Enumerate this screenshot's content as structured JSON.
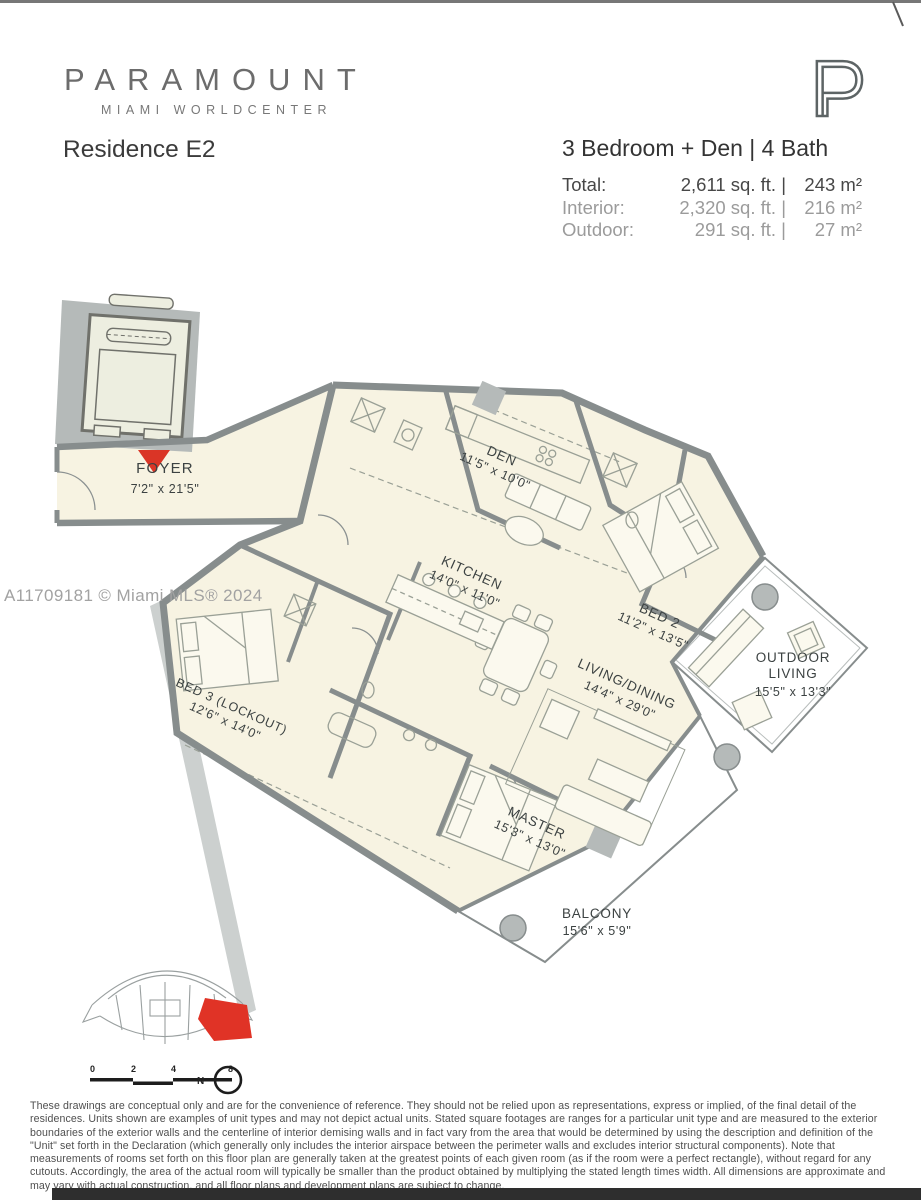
{
  "header": {
    "brand": "PARAMOUNT",
    "brand_subtitle": "MIAMI WORLDCENTER",
    "residence_name": "Residence E2",
    "configuration": "3 Bedroom + Den | 4 Bath",
    "area_rows": [
      {
        "label": "Total:",
        "sqft": "2,611 sq. ft. |",
        "metric": "243 m²"
      },
      {
        "label": "Interior:",
        "sqft": "2,320 sq. ft. |",
        "metric": "216 m²"
      },
      {
        "label": "Outdoor:",
        "sqft": "291 sq. ft. |",
        "metric": "27 m²"
      }
    ]
  },
  "watermark": "A11709181 © Miami MLS® 2024",
  "floorplan": {
    "rooms": {
      "foyer": {
        "name": "FOYER",
        "dims": "7'2\" x 21'5\""
      },
      "den": {
        "name": "DEN",
        "dims": "11'5\" x 10'0\""
      },
      "kitchen": {
        "name": "KITCHEN",
        "dims": "14'0\" x 11'0\""
      },
      "bed2": {
        "name": "BED 2",
        "dims": "11'2\" x 13'5\""
      },
      "living": {
        "name": "LIVING/DINING",
        "dims": "14'4\" x 29'0\""
      },
      "outdoor": {
        "line1": "OUTDOOR",
        "line2": "LIVING",
        "dims": "15'5\" x 13'3\""
      },
      "master": {
        "name": "MASTER",
        "dims": "15'3\" x 13'0\""
      },
      "bed3": {
        "name": "BED 3 (LOCKOUT)",
        "dims": "12'6\" x 14'0\""
      },
      "balcony": {
        "name": "BALCONY",
        "dims": "15'6\" x 5'9\""
      }
    },
    "colors": {
      "floor": "#f7f3e2",
      "wall": "#878d8d",
      "structure": "#b5bab9",
      "accent_red": "#da3526"
    }
  },
  "keyplan": {
    "scale_ticks": [
      "0",
      "2",
      "4",
      "8"
    ],
    "north_label": "N"
  },
  "disclaimer": "These drawings are conceptual only and are for the convenience of reference. They should not be relied upon as representations, express or implied, of the final detail of the residences. Units shown are examples of unit types and may not depict actual units. Stated square footages are ranges for a particular unit type and are measured to the exterior boundaries of the exterior walls and the centerline of interior demising walls and in fact vary from the area that would be determined by using the description and definition of the \"Unit\" set forth in the Declaration (which generally only includes the interior airspace between the perimeter walls and excludes interior structural components). Note that measurements of rooms set forth on this floor plan are generally taken at the greatest points of each given room (as if the room were a perfect rectangle), without regard for any cutouts.  Accordingly, the area of the actual room will typically be smaller than the product obtained by multiplying the stated length times width.  All dimensions are approximate and may vary with actual construction, and all floor plans and development plans are subject to change."
}
